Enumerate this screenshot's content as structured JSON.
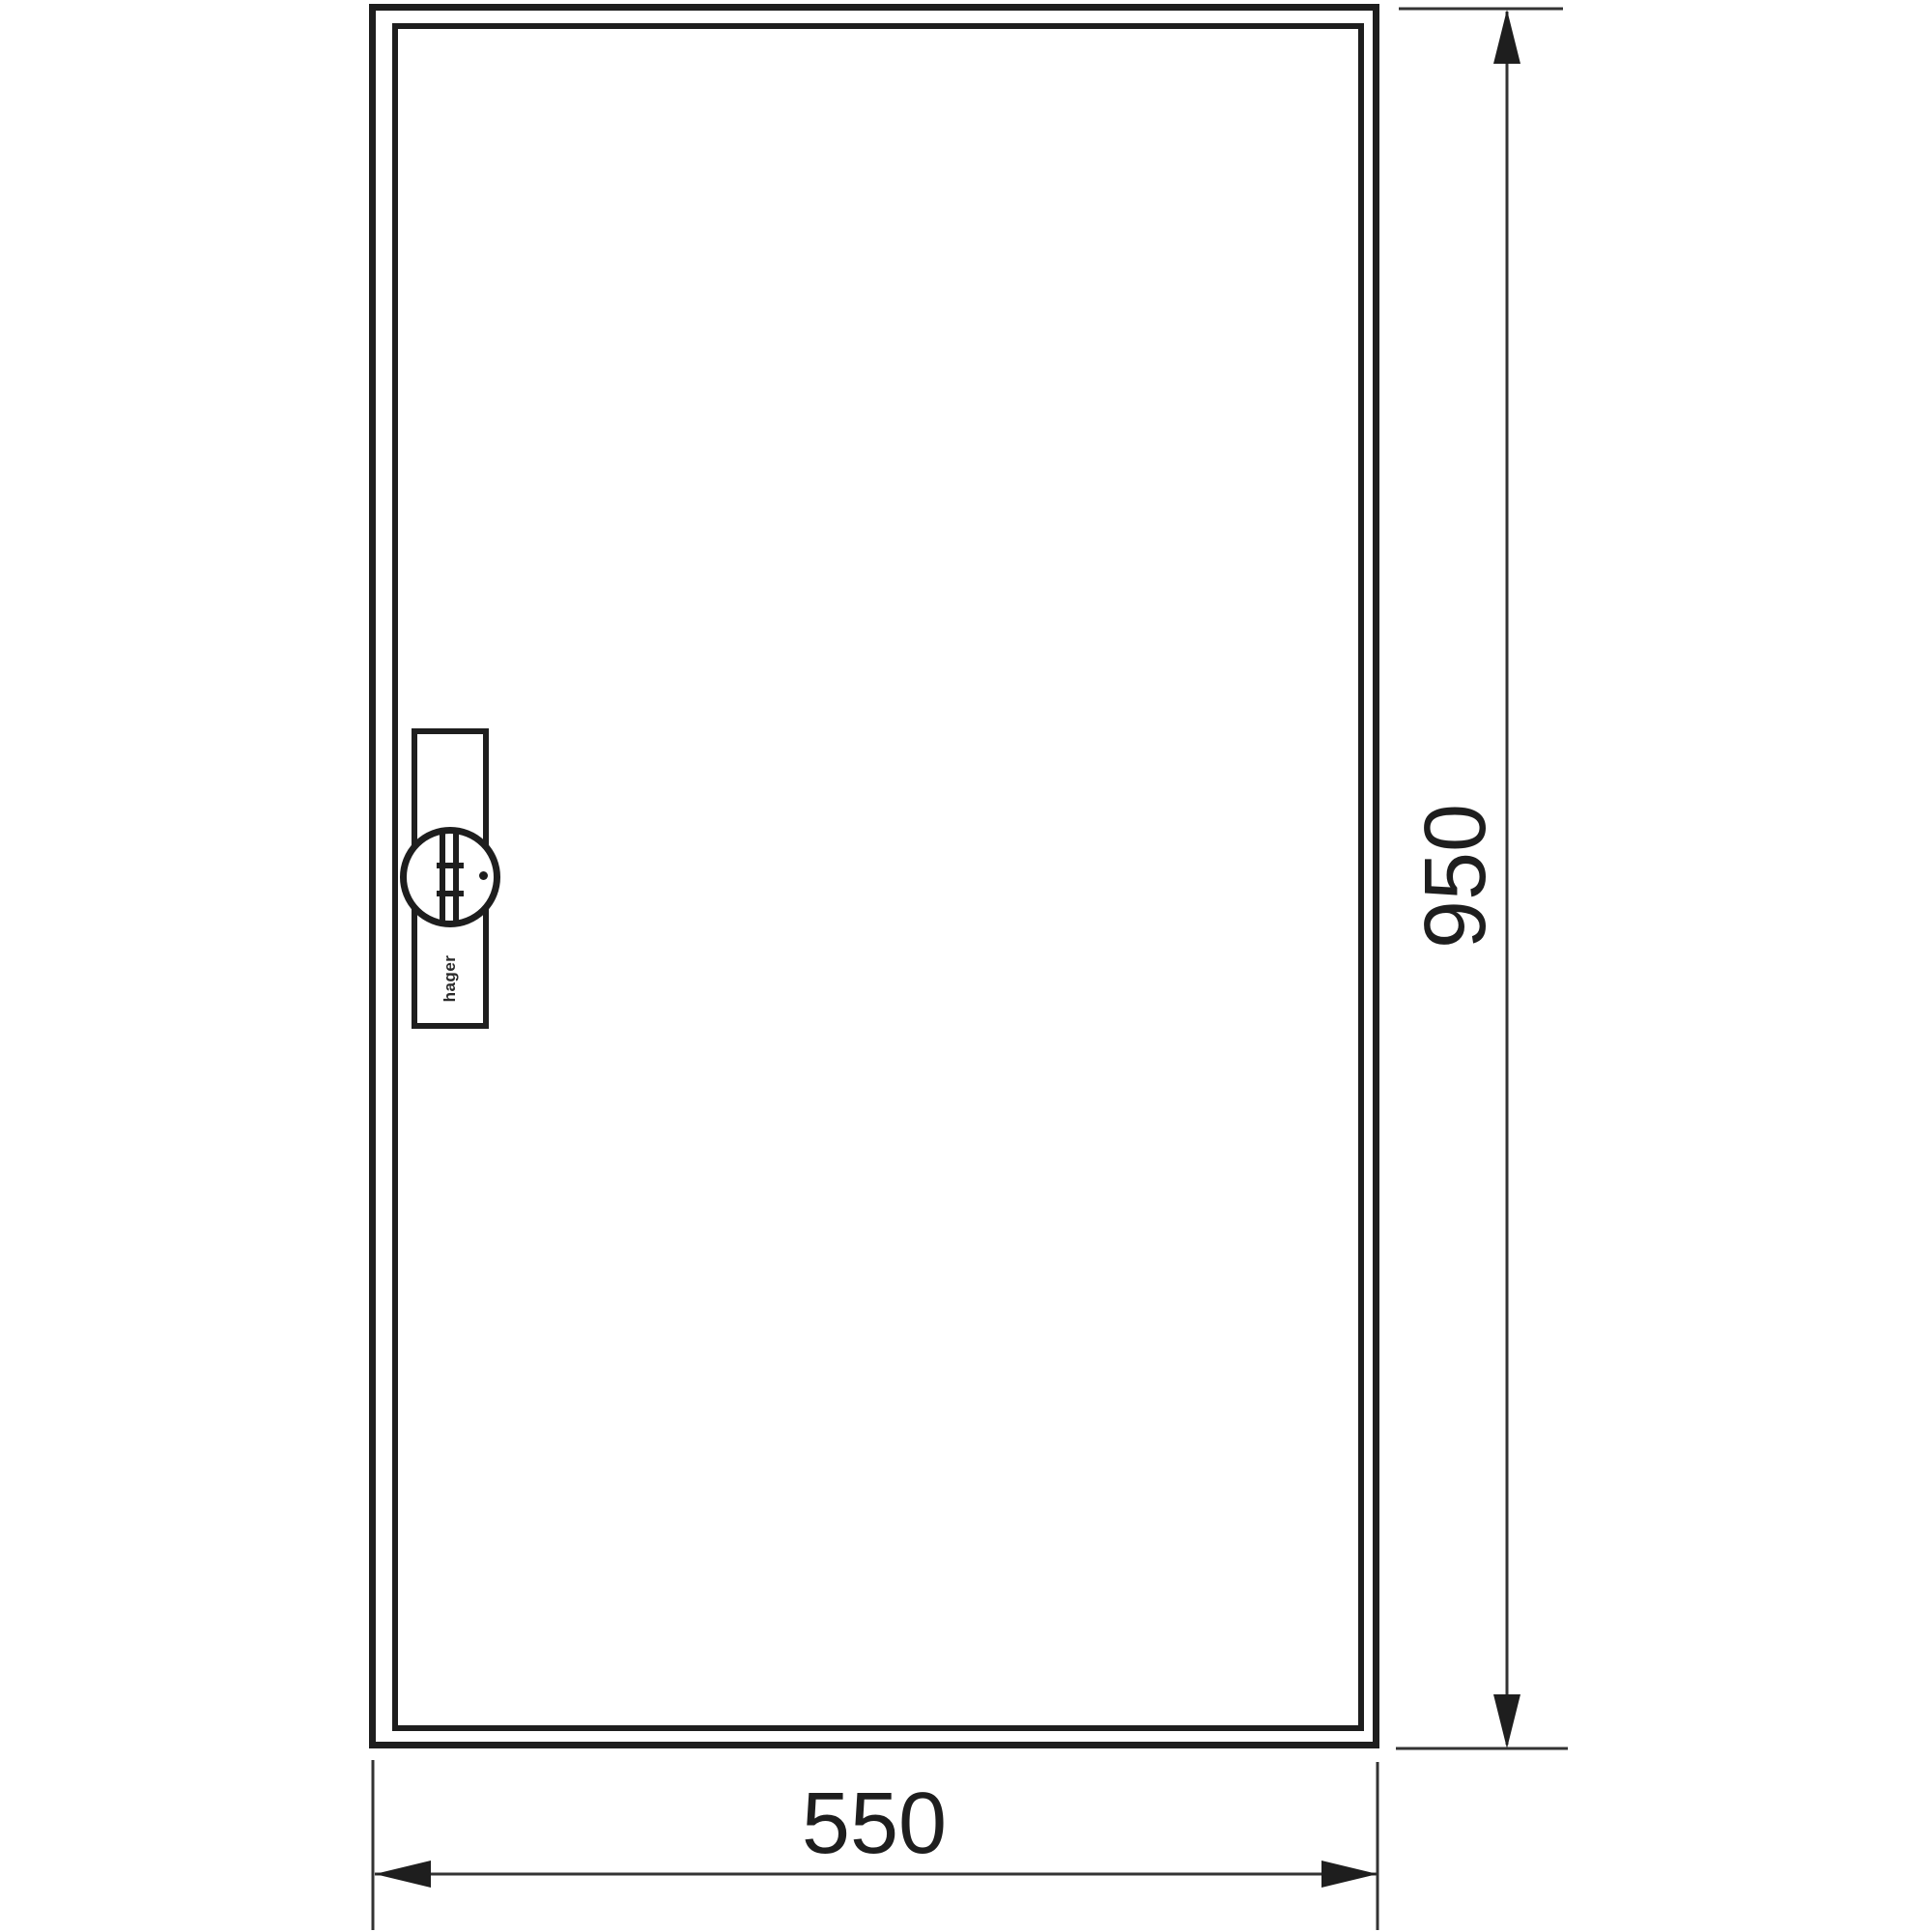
{
  "drawing": {
    "type": "technical-dimension-drawing",
    "subject": "enclosure-front-view",
    "dimension_height": {
      "label": "950"
    },
    "dimension_width": {
      "label": "550"
    },
    "lock": {
      "brand_label": "hager"
    },
    "colors": {
      "frame_line": "#1e1e1e",
      "dimension_line": "#333333",
      "background": "#ffffff"
    }
  }
}
